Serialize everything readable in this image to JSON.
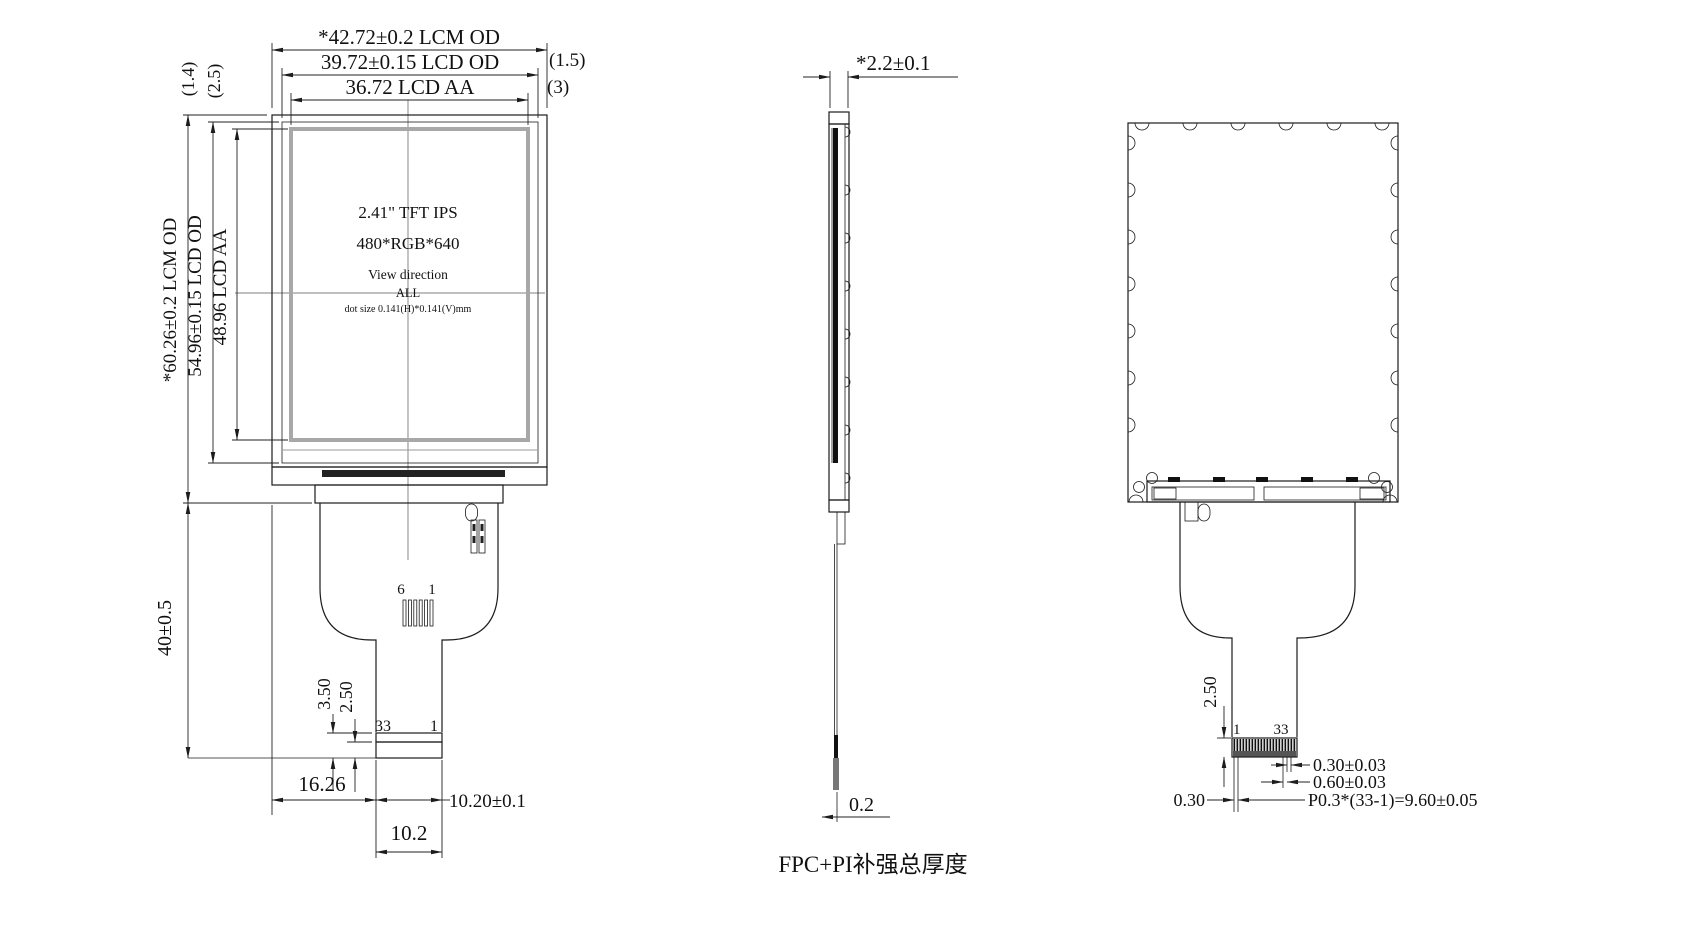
{
  "front": {
    "dim_lcm_width": "*42.72±0.2 LCM OD",
    "dim_lcd_width": "39.72±0.15 LCD OD",
    "dim_aa_width": "36.72 LCD AA",
    "dim_margin_right_lcd": "(1.5)",
    "dim_margin_right_aa": "(3)",
    "dim_margin_left_lcd": "(1.4)",
    "dim_margin_left_aa": "(2.5)",
    "dim_lcm_height": "*60.26±0.2 LCM OD",
    "dim_lcd_height": "54.96±0.15 LCD OD",
    "dim_aa_height": "48.96 LCD AA",
    "dim_fpc_length": "40±0.5",
    "panel_line1": "2.41\" TFT IPS",
    "panel_line2": "480*RGB*640",
    "panel_line3": "View direction",
    "panel_line4": "ALL",
    "panel_line5": "dot size 0.141(H)*0.141(V)mm",
    "pad_num_left": "6",
    "pad_num_right": "1",
    "conn_num_left": "33",
    "conn_num_right": "1",
    "dim_stiffener_len": "3.50",
    "dim_contact_len": "2.50",
    "dim_tail_offset": "16.26",
    "dim_conn_width": "10.20±0.1",
    "dim_tail_width": "10.2"
  },
  "side": {
    "dim_thickness": "*2.2±0.1",
    "dim_fpc_thickness": "0.2",
    "caption": "FPC+PI补强总厚度"
  },
  "back": {
    "conn_num_left": "1",
    "conn_num_right": "33",
    "dim_contact_len": "2.50",
    "dim_pin_width": "0.30±0.03",
    "dim_pin_pair": "0.60±0.03",
    "dim_margin": "0.30",
    "dim_pitch_total": "P0.3*(33-1)=9.60±0.05"
  }
}
